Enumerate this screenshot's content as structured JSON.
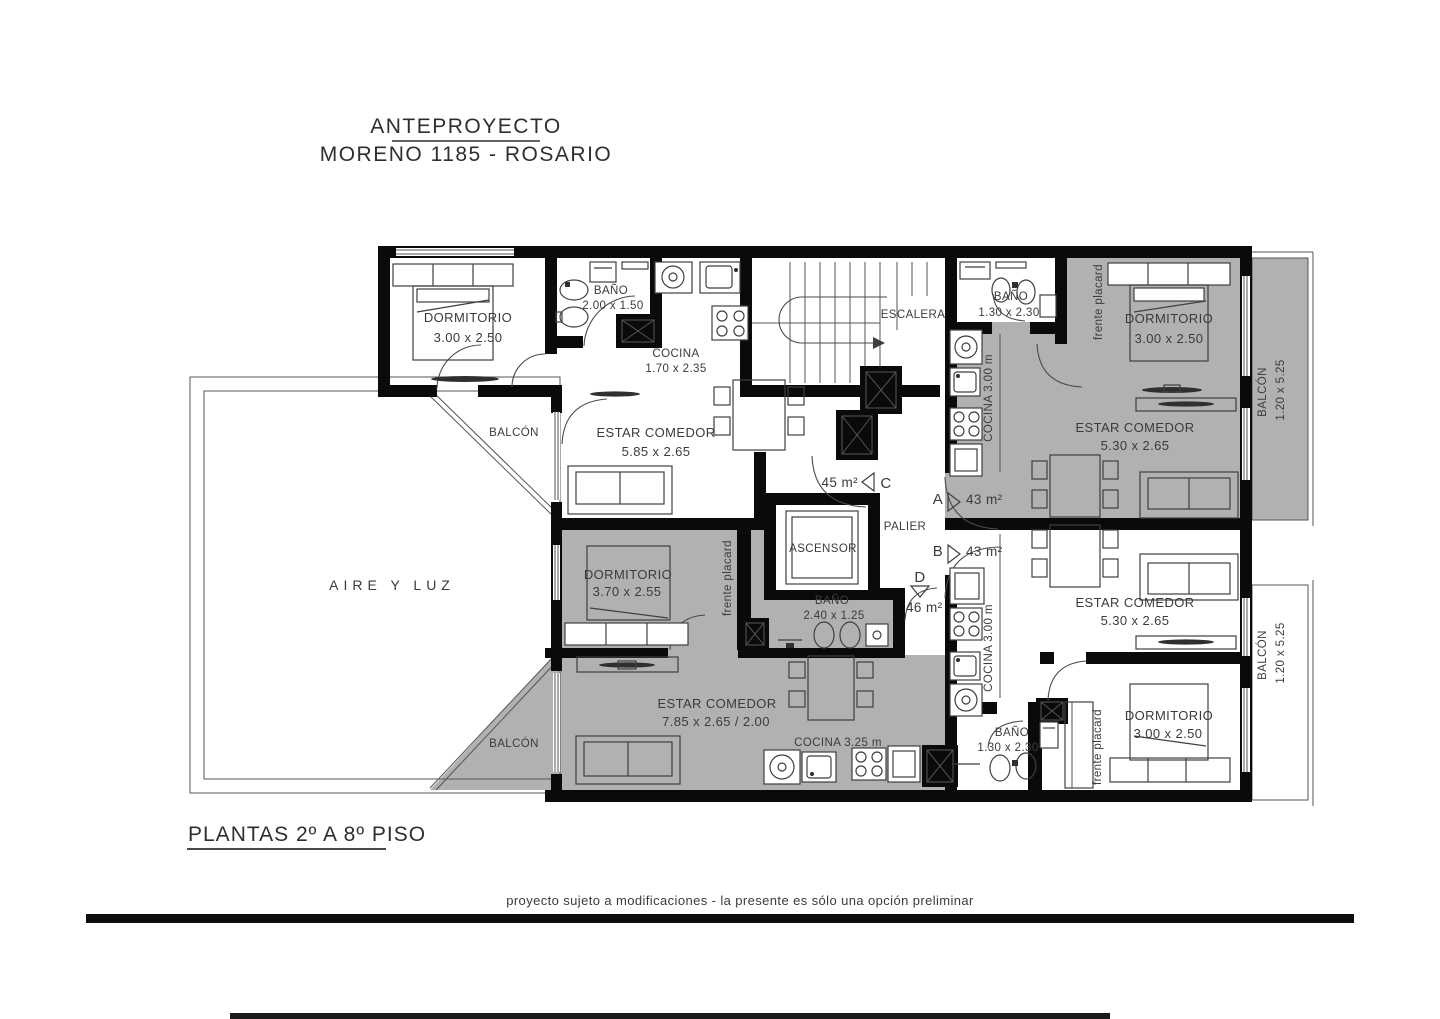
{
  "title": {
    "line1": "ANTEPROYECTO",
    "line2": "MORENO 1185 - ROSARIO"
  },
  "caption": "PLANTAS 2º A 8º PISO",
  "footer": "proyecto sujeto a modificaciones - la presente es sólo una opción preliminar",
  "courtyard": "AIRE Y LUZ",
  "core": {
    "stair": "ESCALERA",
    "elevator": "ASCENSOR",
    "hall": "PALIER"
  },
  "units": {
    "a": {
      "letter": "A",
      "area": "43 m²"
    },
    "b": {
      "letter": "B",
      "area": "43 m²"
    },
    "c": {
      "letter": "C",
      "area": "45 m²"
    },
    "d": {
      "letter": "D",
      "area": "46 m²"
    }
  },
  "rooms": {
    "dorm_tl": {
      "name": "DORMITORIO",
      "dims": "3.00 x 2.50"
    },
    "bano_tl": {
      "name": "BAÑO",
      "dims": "2.00 x 1.50"
    },
    "cocina_tl": {
      "name": "COCINA",
      "dims": "1.70 x 2.35"
    },
    "bano_a": {
      "name": "BAÑO",
      "dims": "1.30 x 2.30"
    },
    "dorm_a": {
      "name": "DORMITORIO",
      "dims": "3.00 x 2.50"
    },
    "estar_c": {
      "name": "ESTAR COMEDOR",
      "dims": "5.85 x 2.65"
    },
    "estar_a": {
      "name": "ESTAR COMEDOR",
      "dims": "5.30 x 2.65"
    },
    "estar_b": {
      "name": "ESTAR COMEDOR",
      "dims": "5.30 x 2.65"
    },
    "estar_d": {
      "name": "ESTAR COMEDOR",
      "dims": "7.85 x 2.65 / 2.00"
    },
    "dorm_d": {
      "name": "DORMITORIO",
      "dims": "3.70 x 2.55"
    },
    "bano_d": {
      "name": "BAÑO",
      "dims": "2.40 x 1.25"
    },
    "bano_b": {
      "name": "BAÑO",
      "dims": "1.30 x 2.30"
    },
    "dorm_b": {
      "name": "DORMITORIO",
      "dims": "3.00 x 2.50"
    },
    "cocina_a": "COCINA 3.00 m",
    "cocina_b": "COCINA 3.00 m",
    "cocina_d": "COCINA 3.25 m",
    "placard": "frente placard",
    "balcon": "BALCÓN",
    "balcon_dims": "1.20 x 5.25"
  },
  "colors": {
    "wall": "#0a0a0a",
    "shade": "#b1b1b1",
    "line": "#3f3f3f"
  }
}
